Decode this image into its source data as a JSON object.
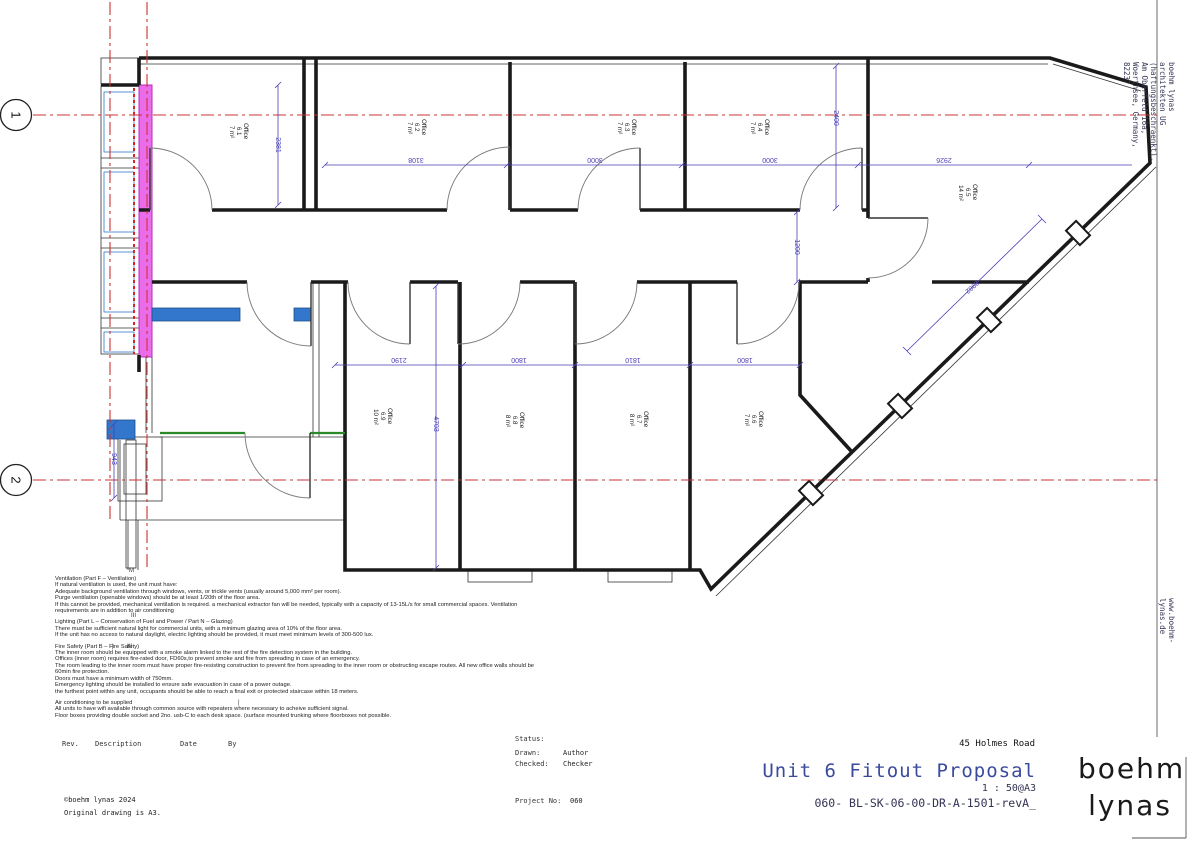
{
  "colors": {
    "wall_black": "#1a1a1a",
    "dimension_blue": "#4a3fb5",
    "grid_red": "#cc3333",
    "wall_highlight_magenta": "#ea6cea",
    "new_partition_blue": "#3377cc",
    "survey_green": "#2a8a2a",
    "title_blue": "#3a4a9d"
  },
  "grid": {
    "bubbles": [
      "1",
      "2"
    ]
  },
  "rooms": [
    {
      "name": "Office",
      "number": "6.1",
      "area": "7 m²"
    },
    {
      "name": "Office",
      "number": "6.2",
      "area": "7 m²"
    },
    {
      "name": "Office",
      "number": "6.3",
      "area": "7 m²"
    },
    {
      "name": "Office",
      "number": "6.4",
      "area": "7 m²"
    },
    {
      "name": "Office",
      "number": "6.5",
      "area": "14 m²"
    },
    {
      "name": "Office",
      "number": "6.6",
      "area": "7 m²"
    },
    {
      "name": "Office",
      "number": "6.7",
      "area": "8 m²"
    },
    {
      "name": "Office",
      "number": "6.8",
      "area": "8 m²"
    },
    {
      "name": "Office",
      "number": "6.9",
      "area": "10 m²"
    }
  ],
  "dims": [
    {
      "value": "2381"
    },
    {
      "value": "3108"
    },
    {
      "value": "3000"
    },
    {
      "value": "3000"
    },
    {
      "value": "2926"
    },
    {
      "value": "2400"
    },
    {
      "value": "1200"
    },
    {
      "value": "2982"
    },
    {
      "value": "2190"
    },
    {
      "value": "1800"
    },
    {
      "value": "1810"
    },
    {
      "value": "1800"
    },
    {
      "value": "4703"
    },
    {
      "value": "943"
    }
  ],
  "marks": [
    "M",
    "III",
    "|",
    "III",
    "|"
  ],
  "notes": {
    "paragraphs": [
      {
        "lines": [
          "Ventilation (Part F – Ventilation)",
          "If natural ventilation is used, the unit must have:",
          "Adequate background ventilation through windows, vents, or trickle vents (usually around 5,000 mm² per room).",
          "Purge ventilation (openable windows) should be at least 1/20th of the floor area.",
          "If this cannot be provided, mechanical ventilation is required. a mechanical extractor fan will be needed, typically with a capacity of 13-15L/s for small commercial spaces. Ventilation",
          "requirements are in addition to air conditioning"
        ]
      },
      {
        "lines": [
          "Lighting (Part L – Conservation of Fuel and Power / Part N – Glazing)",
          "There must be sufficient natural light for commercial units, with a minimum glazing area of 10% of the floor area.",
          "If the unit has no access to natural daylight, electric lighting should be provided, it must meet minimum levels of 300-500 lux."
        ]
      },
      {
        "lines": [
          "Fire Safety (Part B – Fire Safety)",
          "The inner room should be equipped with a smoke alarm linked to the rest of the fire detection system in the building.",
          "Offices (inner room) requires fire-rated door, FD60s,to prevent smoke and fire from spreading in case of an emergency.",
          "The room leading to the inner room must have proper fire-resisting construction to prevent fire from spreading to the inner room or obstructing escape routes.  All new office walls should be",
          "60min fire protection.",
          "Doors must have a minimum width of 750mm.",
          "Emergency lighting should be installed to ensure safe evacuation in case of a power outage.",
          "the furthest point within any unit, occupants should be able to reach a final exit or protected staircase within 18 meters."
        ]
      },
      {
        "lines": [
          "Air conditioning to be supplied",
          "All units to have wifi available through common source with repeaters where necessary to acheive sufficient signal.",
          "Floor boxes providing double socket and 2no. usb-C to each desk space. (surface mounted trunking where floorboxes not possible."
        ]
      }
    ]
  },
  "title_block": {
    "rev_header": {
      "rev": "Rev.",
      "description": "Description",
      "date": "Date",
      "by": "By"
    },
    "copyright": "©boehm lynas 2024",
    "original_note": "Original drawing is A3.",
    "status_label": "Status:",
    "drawn_label": "Drawn:",
    "drawn_value": "Author",
    "checked_label": "Checked:",
    "checked_value": "Checker",
    "project_no_label": "Project No:",
    "project_no_value": "060",
    "address": "45 Holmes Road",
    "title": "Unit 6 Fitout Proposal",
    "scale": "1 : 50@A3",
    "drawing_number": "060- BL-SK-06-00-DR-A-1501-revA_",
    "logo_line1": "boehm",
    "logo_line2": "lynas"
  },
  "side_strip": {
    "firm_line": "boehm lynas architekten UG (haftungsbeschraenkt), Am Oberfeld 16a, Woerthsee, Germany, 82237",
    "website": "www.boehm-lynas.de"
  }
}
